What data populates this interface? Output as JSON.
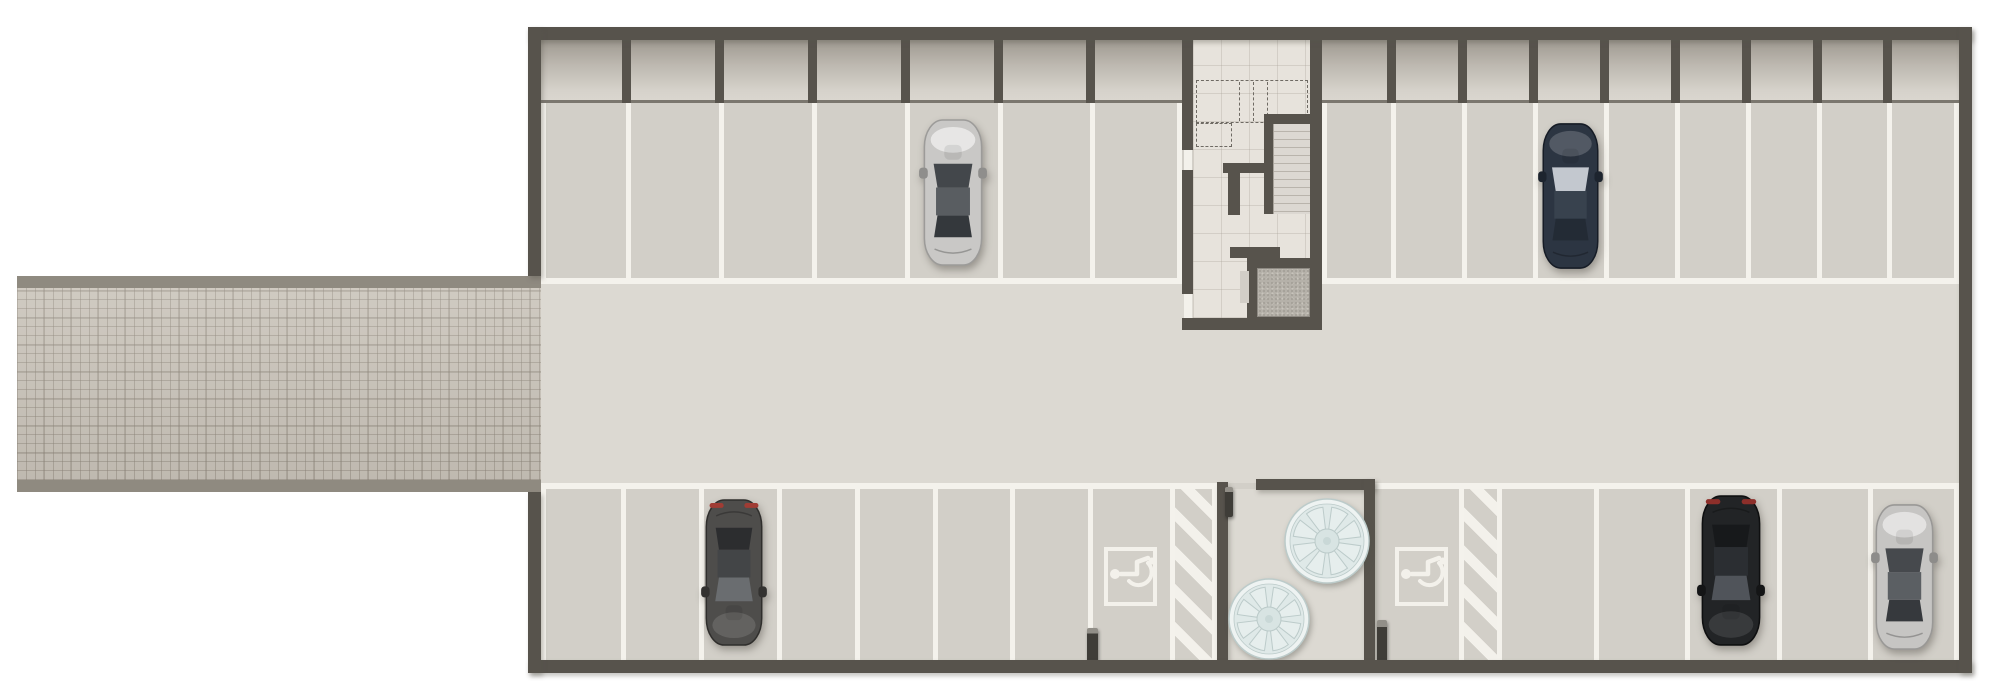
{
  "meta": {
    "width": 2000,
    "height": 700,
    "kind": "parking-garage-floor-plan"
  },
  "palette": {
    "wall": "#57534c",
    "line": "#f4f2ec",
    "paint": "#f3f1eb",
    "floorStall": "#d2cfc8",
    "floorAisle": "#dcd9d2",
    "floorCore": "#e7e3dc",
    "cellEdge": "#7b776f",
    "curb": "#8f8a80",
    "elevatorDoor": "#d2cec7",
    "dash": "#6e6a63",
    "fanFace": "#dfe9e8",
    "fanRim": "#eef3f2",
    "fanLine": "#bccbca",
    "fanHub": "#d8e4e3",
    "fanWedge": "#e6eeed",
    "bollard": "#3f3d38"
  },
  "car_schemes": {
    "silver": {
      "body": "#c9c8c6",
      "edge": "#9c9b99",
      "sheen": "rgba(255,255,255,.55)",
      "wind": "#43474b",
      "roof": "#595d61",
      "rear": "#34383c",
      "mirror": "#8f8e8c",
      "tail": ""
    },
    "navy": {
      "body": "#2c3542",
      "edge": "#161c26",
      "sheen": "rgba(255,255,255,.18)",
      "wind": "#c3c8cf",
      "roof": "#38424e",
      "rear": "#232b35",
      "mirror": "#1d242e",
      "tail": ""
    },
    "graydark": {
      "body": "#4e4d4b",
      "edge": "#2f2e2c",
      "sheen": "rgba(255,255,255,.12)",
      "wind": "#6a6d70",
      "roof": "#434547",
      "rear": "#2c2d2f",
      "mirror": "#333230",
      "tail": "#a03c34"
    },
    "black": {
      "body": "#222426",
      "edge": "#0e0f10",
      "sheen": "rgba(255,255,255,.10)",
      "wind": "#50545a",
      "roof": "#2b2e32",
      "rear": "#17191b",
      "mirror": "#141516",
      "tail": "#8d2f2a"
    },
    "silver2": {
      "body": "#c6c5c3",
      "edge": "#999896",
      "sheen": "rgba(255,255,255,.5)",
      "wind": "#46494d",
      "roof": "#5b5f63",
      "rear": "#36393d",
      "mirror": "#8d8c8a",
      "tail": ""
    }
  },
  "elements": [
    {
      "t": "rect",
      "n": "ramp-curb-top",
      "x": 17,
      "y": 276,
      "w": 524,
      "h": 12,
      "f": "curb"
    },
    {
      "t": "brick",
      "n": "entrance-ramp",
      "x": 17,
      "y": 288,
      "w": 524,
      "h": 192
    },
    {
      "t": "rect",
      "n": "ramp-curb-bottom",
      "x": 17,
      "y": 480,
      "w": 524,
      "h": 12,
      "f": "curb"
    },
    {
      "t": "rect",
      "n": "garage-floor",
      "x": 541,
      "y": 40,
      "w": 1418,
      "h": 620,
      "f": "floorStall"
    },
    {
      "t": "rect",
      "n": "drive-aisle",
      "x": 541,
      "y": 283,
      "w": 1418,
      "h": 200,
      "f": "floorAisle"
    },
    {
      "t": "cells",
      "n": "storage-cells-left",
      "x": 541,
      "y": 40,
      "w": 641,
      "h": 60
    },
    {
      "t": "cells",
      "n": "storage-cells-right",
      "x": 1322,
      "y": 40,
      "w": 637,
      "h": 60
    },
    {
      "t": "rect",
      "n": "storage-cells-edge-left",
      "x": 541,
      "y": 100,
      "w": 641,
      "h": 3,
      "f": "cellEdge"
    },
    {
      "t": "rect",
      "n": "storage-cells-edge-right",
      "x": 1322,
      "y": 100,
      "w": 637,
      "h": 3,
      "f": "cellEdge"
    },
    {
      "t": "divs",
      "n": "storage-cell-divider",
      "xs": [
        622,
        715,
        808,
        901,
        994,
        1086
      ],
      "y": 40,
      "w": 9,
      "h": 63,
      "f": "wall"
    },
    {
      "t": "divs",
      "n": "storage-cell-divider",
      "xs": [
        1387,
        1458,
        1529,
        1600,
        1671,
        1742,
        1813,
        1883
      ],
      "y": 40,
      "w": 9,
      "h": 63,
      "f": "wall"
    },
    {
      "t": "divs",
      "n": "stall-line-top-left",
      "xs": [
        541,
        626,
        719,
        812,
        905,
        998,
        1090,
        1177
      ],
      "y": 103,
      "w": 5,
      "h": 181,
      "f": "line"
    },
    {
      "t": "divs",
      "n": "stall-line-top-right",
      "xs": [
        1322,
        1391,
        1462,
        1533,
        1604,
        1675,
        1746,
        1817,
        1887,
        1954
      ],
      "y": 103,
      "w": 5,
      "h": 181,
      "f": "line"
    },
    {
      "t": "rect",
      "n": "stall-front-line-top-left",
      "x": 541,
      "y": 278,
      "w": 641,
      "h": 6,
      "f": "line"
    },
    {
      "t": "rect",
      "n": "stall-front-line-top-right",
      "x": 1322,
      "y": 278,
      "w": 637,
      "h": 6,
      "f": "line"
    },
    {
      "t": "rect",
      "n": "stall-front-line-bottom-left",
      "x": 541,
      "y": 483,
      "w": 676,
      "h": 6,
      "f": "line"
    },
    {
      "t": "rect",
      "n": "stall-front-line-bottom-right",
      "x": 1375,
      "y": 483,
      "w": 584,
      "h": 6,
      "f": "line"
    },
    {
      "t": "divs",
      "n": "stall-line-bottom-left",
      "xs": [
        541,
        621,
        699,
        777,
        855,
        933,
        1010,
        1088,
        1170,
        1212
      ],
      "y": 489,
      "w": 5,
      "h": 171,
      "f": "line"
    },
    {
      "t": "divs",
      "n": "stall-line-bottom-right",
      "xs": [
        1459,
        1497,
        1594,
        1685,
        1777,
        1868,
        1954
      ],
      "y": 489,
      "w": 5,
      "h": 171,
      "f": "line"
    },
    {
      "t": "hatch",
      "n": "no-parking-hatch-left",
      "x": 1175,
      "y": 489,
      "w": 37,
      "h": 171
    },
    {
      "t": "hatch",
      "n": "no-parking-hatch-right",
      "x": 1464,
      "y": 489,
      "w": 33,
      "h": 171
    },
    {
      "t": "rect",
      "n": "equipment-alcove-floor",
      "x": 1228,
      "y": 489,
      "w": 136,
      "h": 171,
      "f": "floorAisle"
    },
    {
      "t": "rect",
      "n": "alcove-wall-left",
      "x": 1217,
      "y": 482,
      "w": 11,
      "h": 178,
      "f": "wall",
      "sh": 1
    },
    {
      "t": "rect",
      "n": "alcove-wall-top",
      "x": 1256,
      "y": 479,
      "w": 119,
      "h": 11,
      "f": "wall",
      "sh": 1
    },
    {
      "t": "rect",
      "n": "alcove-wall-right",
      "x": 1364,
      "y": 479,
      "w": 11,
      "h": 181,
      "f": "wall",
      "sh": 1
    },
    {
      "t": "fan",
      "n": "ventilation-fan-large",
      "cx": 1327,
      "cy": 541,
      "r": 42
    },
    {
      "t": "fan",
      "n": "ventilation-fan-small",
      "cx": 1269,
      "cy": 619,
      "r": 40
    },
    {
      "t": "isa",
      "n": "accessible-parking-symbol-left",
      "x": 1104,
      "y": 547,
      "w": 53,
      "h": 59
    },
    {
      "t": "isa",
      "n": "accessible-parking-symbol-right",
      "x": 1395,
      "y": 547,
      "w": 53,
      "h": 59
    },
    {
      "t": "bollard",
      "n": "bollard-alcove-entry",
      "x": 1225,
      "y": 487,
      "w": 8,
      "h": 30
    },
    {
      "t": "bollard",
      "n": "bollard-left",
      "x": 1087,
      "y": 628,
      "w": 11,
      "h": 34
    },
    {
      "t": "bollard",
      "n": "bollard-right",
      "x": 1377,
      "y": 620,
      "w": 10,
      "h": 43
    },
    {
      "t": "coretile",
      "n": "stair-core-floor",
      "x": 1193,
      "y": 40,
      "w": 117,
      "h": 278
    },
    {
      "t": "dashedRect",
      "n": "overhead-dashed-outline",
      "x": 1196,
      "y": 80,
      "w": 112,
      "h": 43
    },
    {
      "t": "dashedRect",
      "n": "overhead-dashed-outline-small",
      "x": 1196,
      "y": 123,
      "w": 36,
      "h": 24
    },
    {
      "t": "dashedV",
      "n": "overhead-dashed-line",
      "xs": [
        1239,
        1253,
        1267
      ],
      "y": 82,
      "h": 39
    },
    {
      "t": "rect",
      "n": "stair-top-wall",
      "x": 1264,
      "y": 114,
      "w": 46,
      "h": 10,
      "f": "wall"
    },
    {
      "t": "rect",
      "n": "stair-side-wall",
      "x": 1264,
      "y": 124,
      "w": 9,
      "h": 90,
      "f": "wall"
    },
    {
      "t": "stairs",
      "n": "stair-flight",
      "x": 1273,
      "y": 124,
      "w": 37,
      "h": 90
    },
    {
      "t": "rect",
      "n": "landing-wall-h",
      "x": 1223,
      "y": 163,
      "w": 44,
      "h": 10,
      "f": "wall"
    },
    {
      "t": "rect",
      "n": "landing-wall-v",
      "x": 1228,
      "y": 173,
      "w": 12,
      "h": 42,
      "f": "wall"
    },
    {
      "t": "rect",
      "n": "core-stub-wall",
      "x": 1230,
      "y": 247,
      "w": 50,
      "h": 11,
      "f": "wall"
    },
    {
      "t": "rect",
      "n": "elevator-wall-top",
      "x": 1247,
      "y": 258,
      "w": 75,
      "h": 10,
      "f": "wall"
    },
    {
      "t": "rect",
      "n": "elevator-wall-left",
      "x": 1247,
      "y": 268,
      "w": 10,
      "h": 49,
      "f": "wall"
    },
    {
      "t": "rect",
      "n": "elevator-wall-bottom",
      "x": 1247,
      "y": 317,
      "w": 75,
      "h": 11,
      "f": "wall"
    },
    {
      "t": "speckle",
      "n": "elevator-cab-floor",
      "x": 1257,
      "y": 268,
      "w": 53,
      "h": 49
    },
    {
      "t": "rect",
      "n": "elevator-door",
      "x": 1240,
      "y": 271,
      "w": 9,
      "h": 32,
      "f": "elevatorDoor"
    },
    {
      "t": "rect",
      "n": "core-wall-left-upper",
      "x": 1182,
      "y": 40,
      "w": 11,
      "h": 110,
      "f": "wall"
    },
    {
      "t": "rect",
      "n": "core-wall-left-mid",
      "x": 1182,
      "y": 170,
      "w": 11,
      "h": 124,
      "f": "wall"
    },
    {
      "t": "rect",
      "n": "core-wall-right",
      "x": 1310,
      "y": 40,
      "w": 12,
      "h": 278,
      "f": "wall"
    },
    {
      "t": "rect",
      "n": "core-wall-bottom",
      "x": 1182,
      "y": 318,
      "w": 140,
      "h": 12,
      "f": "wall"
    },
    {
      "t": "rect",
      "n": "door-leaf",
      "x": 1184,
      "y": 150,
      "w": 8,
      "h": 20,
      "f": "paint"
    },
    {
      "t": "rect",
      "n": "door-leaf",
      "x": 1184,
      "y": 294,
      "w": 8,
      "h": 24,
      "f": "paint"
    },
    {
      "t": "rect",
      "n": "wall-top",
      "x": 528,
      "y": 27,
      "w": 1444,
      "h": 13,
      "f": "wall",
      "sh": 1
    },
    {
      "t": "rect",
      "n": "wall-bottom",
      "x": 528,
      "y": 660,
      "w": 1444,
      "h": 13,
      "f": "wall",
      "sh": 1
    },
    {
      "t": "rect",
      "n": "wall-left-upper",
      "x": 528,
      "y": 27,
      "w": 13,
      "h": 249,
      "f": "wall",
      "sh": 1
    },
    {
      "t": "rect",
      "n": "wall-left-lower",
      "x": 528,
      "y": 492,
      "w": 13,
      "h": 181,
      "f": "wall",
      "sh": 1
    },
    {
      "t": "rect",
      "n": "wall-right",
      "x": 1959,
      "y": 27,
      "w": 13,
      "h": 646,
      "f": "wall",
      "sh": 1
    },
    {
      "t": "car",
      "n": "car-silver-top",
      "x": 921,
      "y": 118,
      "w": 64,
      "h": 149,
      "front": "up",
      "scheme": "silver"
    },
    {
      "t": "car",
      "n": "car-navy-top",
      "x": 1540,
      "y": 122,
      "w": 61,
      "h": 148,
      "front": "up",
      "scheme": "navy"
    },
    {
      "t": "car",
      "n": "car-gray-bottom",
      "x": 703,
      "y": 498,
      "w": 62,
      "h": 149,
      "front": "down",
      "scheme": "graydark"
    },
    {
      "t": "car",
      "n": "car-black-bottom",
      "x": 1699,
      "y": 494,
      "w": 64,
      "h": 153,
      "front": "down",
      "scheme": "black"
    },
    {
      "t": "car",
      "n": "car-silver-bottom",
      "x": 1873,
      "y": 503,
      "w": 63,
      "h": 148,
      "front": "up",
      "scheme": "silver2"
    }
  ]
}
